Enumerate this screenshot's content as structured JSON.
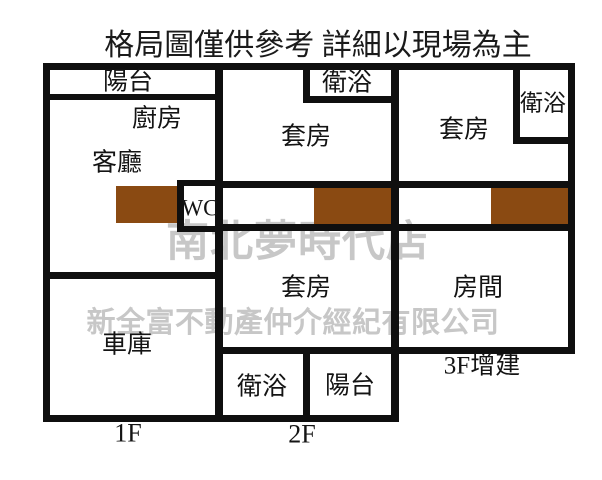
{
  "title": "格局圖僅供參考 詳細以現場為主",
  "watermarks": {
    "store": "南北夢時代店",
    "company": "新全富不動產仲介經紀有限公司"
  },
  "rooms": {
    "f1_balcony": "陽台",
    "f1_kitchen": "廚房",
    "f1_living": "客廳",
    "f1_wc": "WC",
    "f1_garage": "車庫",
    "f2_bath_top": "衛浴",
    "f2_suite_top": "套房",
    "f2_suite_bottom": "套房",
    "f2_bath_bottom": "衛浴",
    "f2_balcony": "陽台",
    "f3_suite": "套房",
    "f3_bath": "衛浴",
    "f3_room": "房間"
  },
  "floor_labels": {
    "f1": "1F",
    "f2": "2F",
    "f3": "3F增建"
  },
  "colors": {
    "wall": "#0f0f0f",
    "stairs": "#8a4a12",
    "watermark": "#c7c7c7"
  }
}
